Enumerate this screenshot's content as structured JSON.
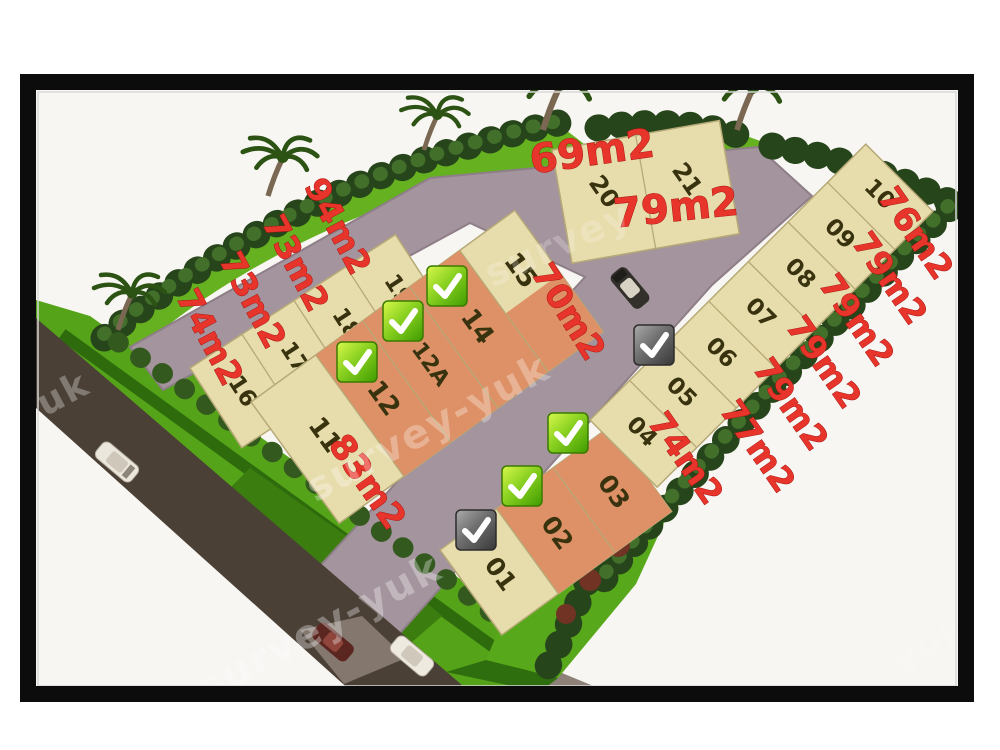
{
  "image_type": "land plot site plan",
  "watermark": {
    "full": "survey-yuk",
    "word1": "survey",
    "word2": "yuk"
  },
  "lots": [
    {
      "number": "01"
    },
    {
      "number": "02"
    },
    {
      "number": "03"
    },
    {
      "number": "04"
    },
    {
      "number": "05"
    },
    {
      "number": "06"
    },
    {
      "number": "07"
    },
    {
      "number": "08"
    },
    {
      "number": "09"
    },
    {
      "number": "10"
    },
    {
      "number": "11"
    },
    {
      "number": "12"
    },
    {
      "number": "12A"
    },
    {
      "number": "14"
    },
    {
      "number": "15"
    },
    {
      "number": "16"
    },
    {
      "number": "17"
    },
    {
      "number": "18"
    },
    {
      "number": "19"
    },
    {
      "number": "20"
    },
    {
      "number": "21"
    }
  ],
  "area_labels": [
    {
      "lot": "20",
      "text": "69m2"
    },
    {
      "lot": "21",
      "text": "79m2"
    },
    {
      "lot": "10",
      "text": "76m2"
    },
    {
      "lot": "09",
      "text": "79m2"
    },
    {
      "lot": "08",
      "text": "79m2"
    },
    {
      "lot": "07",
      "text": "79m2"
    },
    {
      "lot": "06",
      "text": "79m2"
    },
    {
      "lot": "05",
      "text": "77m2"
    },
    {
      "lot": "04",
      "text": "74m2"
    },
    {
      "lot": "19",
      "text": "94m2"
    },
    {
      "lot": "18",
      "text": "73m2"
    },
    {
      "lot": "17",
      "text": "73m2"
    },
    {
      "lot": "16",
      "text": "74m2"
    },
    {
      "lot": "15",
      "text": "70m2"
    },
    {
      "lot": "11",
      "text": "83m2"
    }
  ],
  "checkmarks": {
    "green_on_lots": [
      "12",
      "12A",
      "14",
      "02",
      "03"
    ],
    "gray_on_lots": [
      "01",
      "06"
    ]
  },
  "icons": {
    "green_check": "green-check-icon",
    "gray_check": "gray-check-icon",
    "palm_tree": "palm-tree-icon",
    "car": "car-icon"
  },
  "colors": {
    "lot_cream": "#e7dcab",
    "lot_orange": "#de9166",
    "road_paved": "#a4949d",
    "road_dark": "#4b4036",
    "grass": "#66b120",
    "hedge": "#27451b",
    "label_red": "#e8352b",
    "check_green": "#8ad121",
    "check_gray": "#6e6e6e",
    "frame_black": "#0c0c0c"
  }
}
